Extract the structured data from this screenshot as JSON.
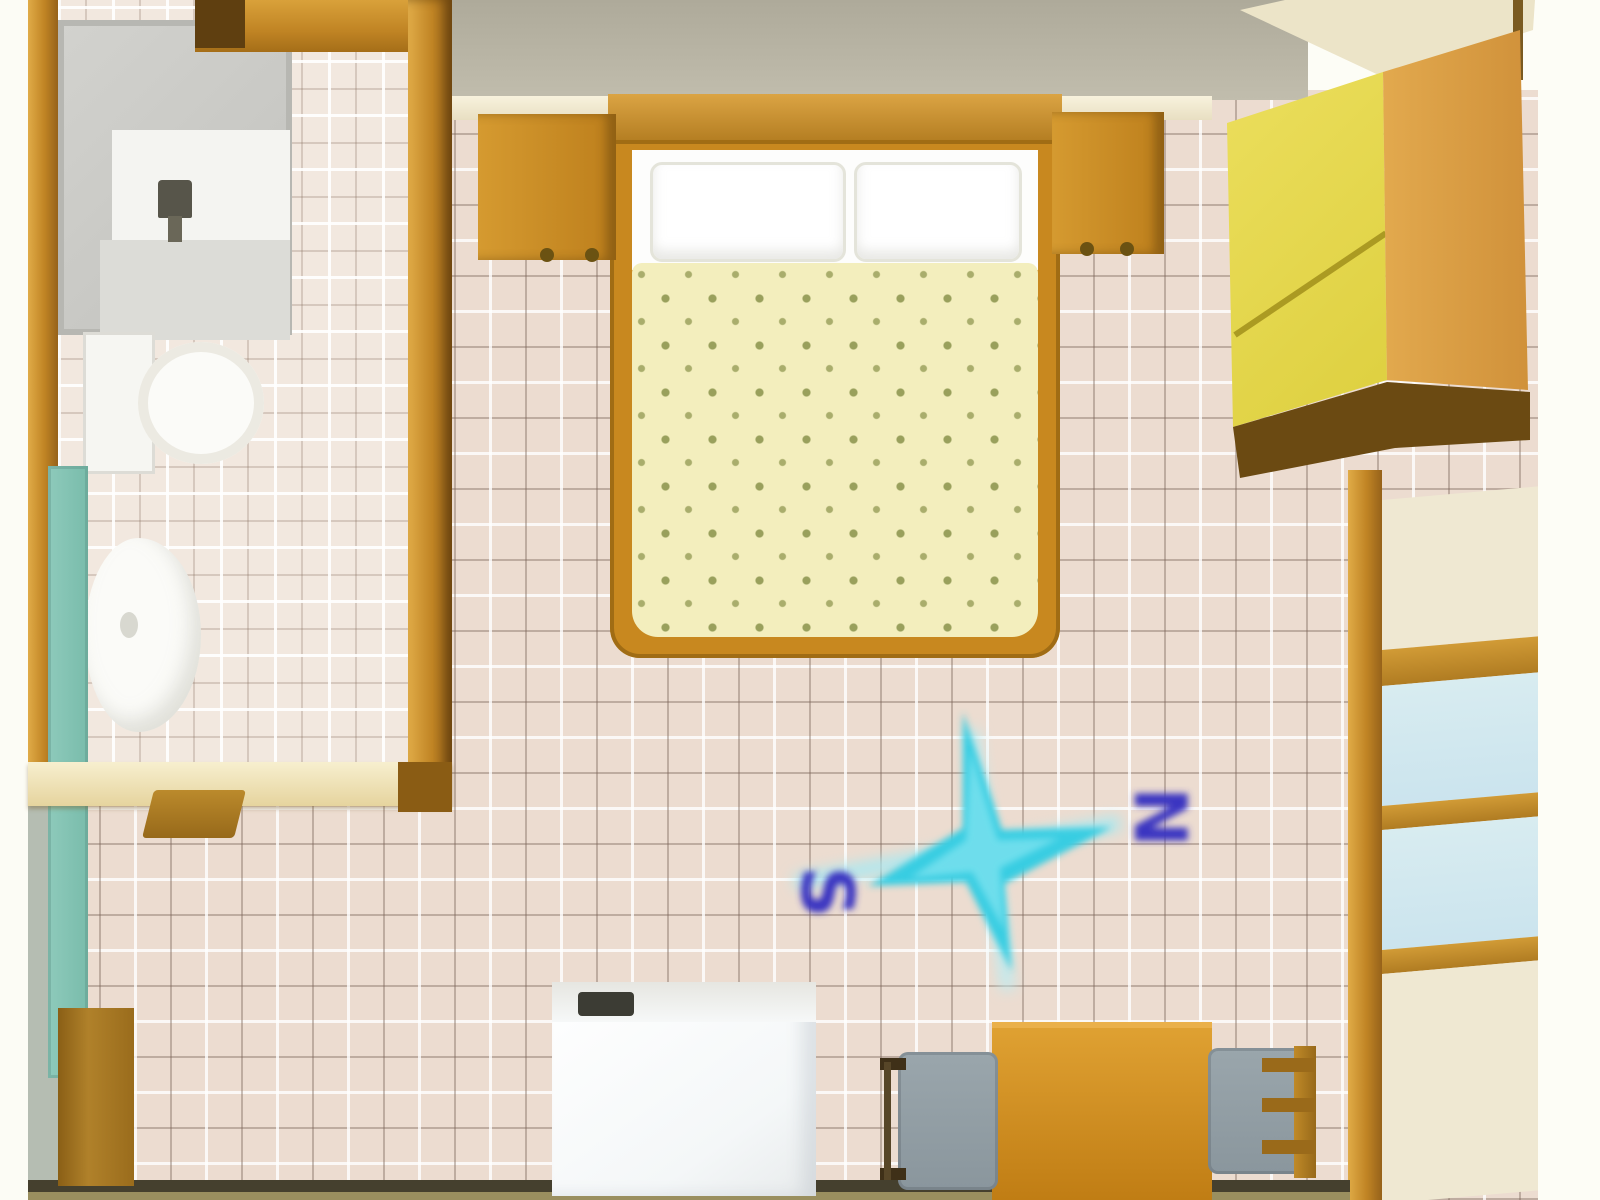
{
  "scene": {
    "title": "Studio apartment floor plan — top-down 3D render",
    "view": "top-down",
    "rooms": [
      "bathroom",
      "main-room"
    ]
  },
  "compass": {
    "south_label": "S",
    "north_label": "N",
    "star_color": "#38cde2",
    "glow_color": "#a9e9f2",
    "label_color": "#3b36c1"
  },
  "colors": {
    "floor_tile": "#ecdcd0",
    "bathroom_tile": "#f2e8df",
    "grout_light": "#ffffff",
    "grout_dark": "#7a6458",
    "wall_wood": "#c08424",
    "wall_wood_dark": "#7d5310",
    "outside_top": "#b2ae9e",
    "outside_margin": "#fdfdf6",
    "bed_frame": "#c8881f",
    "headboard": "#b27a1c",
    "pillow": "#ffffff",
    "duvet": "#f3eebd",
    "duvet_dots": "#99a05c",
    "nightstand": "#c68a22",
    "wardrobe_front": "#e5d84e",
    "wardrobe_side": "#db9f45",
    "wardrobe_shadow": "#6b4a12",
    "window_pane": "#cfe7ef",
    "window_frame": "#c59231",
    "cream_panel": "#efe8d2",
    "desk": "#ce8d1e",
    "chair": "#95a1a7",
    "fridge": "#f8fbfe",
    "fridge_handle": "#3c3c34",
    "fixture_white": "#f7f7f3",
    "shower_gray": "#c8c8c4",
    "radiator_teal": "#84c4b4",
    "bottom_wall": "#45402e"
  },
  "furniture": {
    "items": [
      "shower-cabin",
      "toilet",
      "washbasin",
      "towel-radiator",
      "double-bed",
      "pillow-left",
      "pillow-right",
      "nightstand-left",
      "nightstand-right",
      "wardrobe",
      "window-wall",
      "refrigerator",
      "desk",
      "chair-left",
      "chair-right",
      "side-cabinet",
      "bathroom-door"
    ]
  }
}
